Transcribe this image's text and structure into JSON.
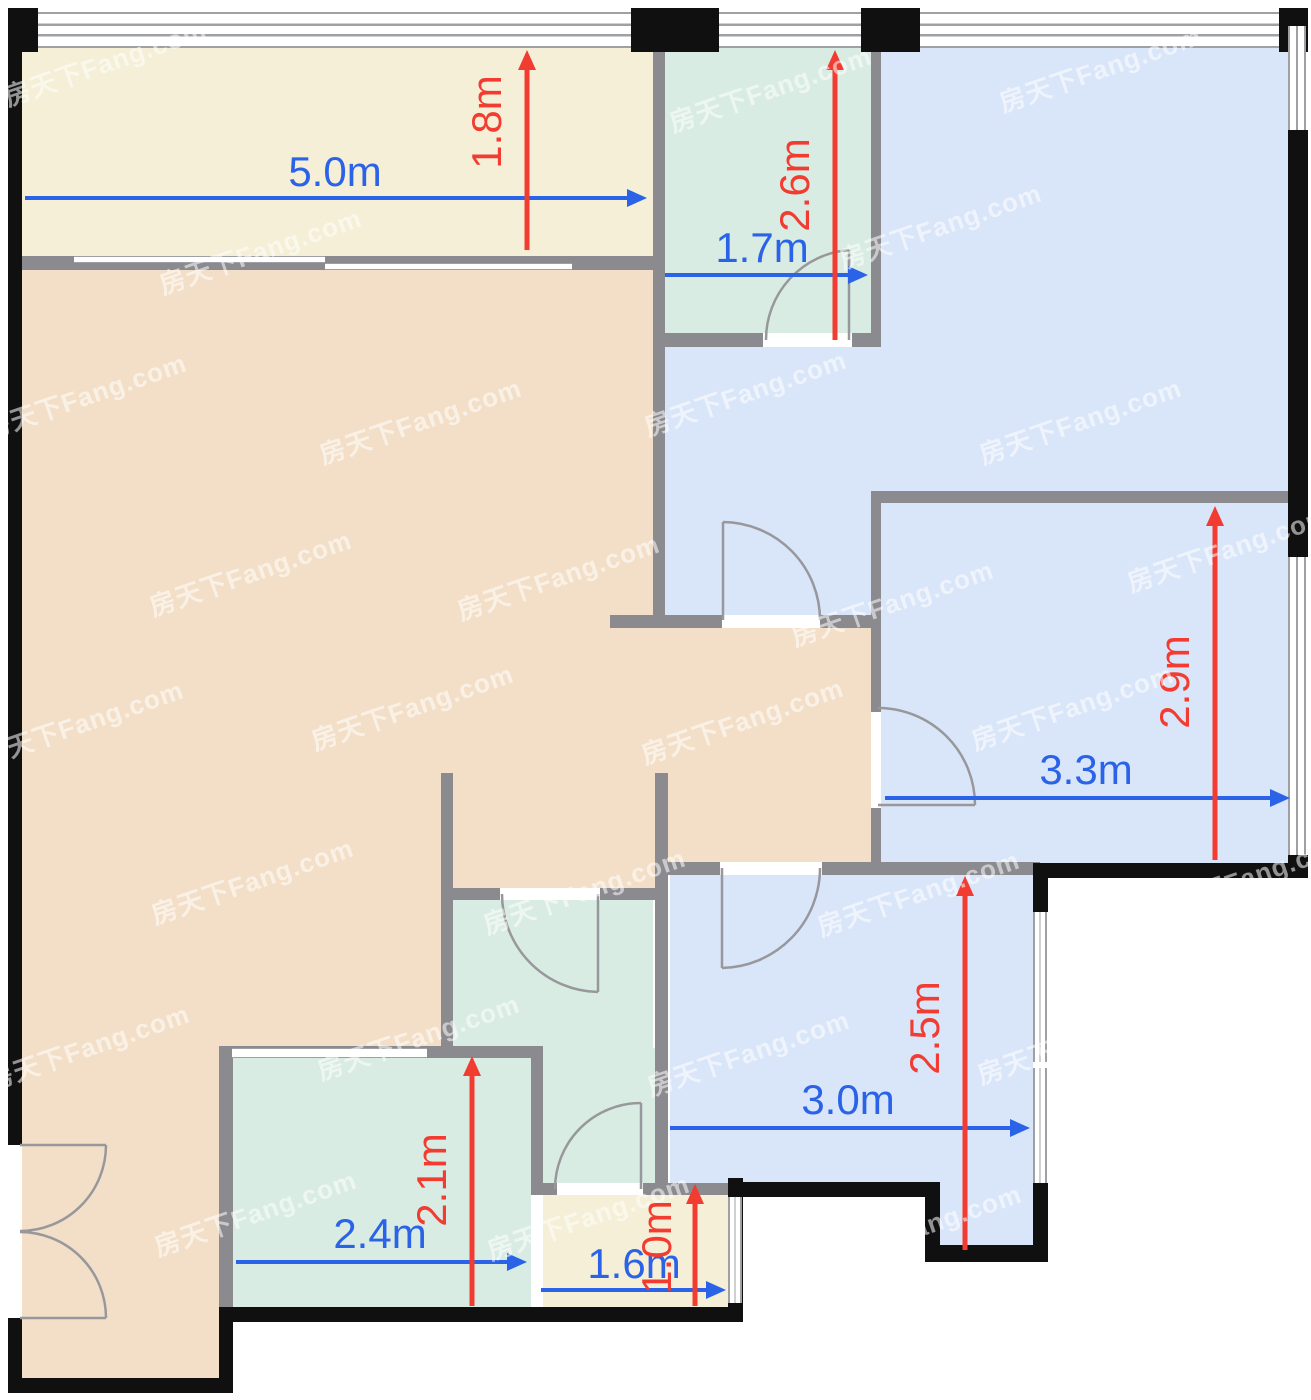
{
  "plan": {
    "width": 1311,
    "height": 1400,
    "watermark_text": "房天下Fang.com"
  },
  "colors": {
    "cream": "#f4efd6",
    "peach": "#f3dfc8",
    "teal": "#d9ece3",
    "blue": "#d9e5f9",
    "wall_gray": "#8b8b8f",
    "wall_black": "#101010",
    "dim_blue": "#2b63e8",
    "dim_red": "#f23c31",
    "door_stroke": "#98989c",
    "window_frame": "#9fa0a4",
    "watermark": "rgba(255,255,255,0.55)"
  },
  "rooms": [
    {
      "name": "balcony",
      "color": "cream",
      "rects": [
        [
          22,
          48,
          631,
          208
        ]
      ]
    },
    {
      "name": "living-room",
      "color": "peach",
      "rects": [
        [
          22,
          258,
          643,
          639
        ],
        [
          22,
          897,
          419,
          151
        ],
        [
          22,
          1048,
          197,
          337
        ],
        [
          653,
          628,
          228,
          234
        ]
      ]
    },
    {
      "name": "bedroom-top-right",
      "color": "blue",
      "rects": [
        [
          881,
          48,
          407,
          449
        ],
        [
          665,
          347,
          216,
          275
        ]
      ]
    },
    {
      "name": "utility-top",
      "color": "teal",
      "rects": [
        [
          663,
          48,
          208,
          289
        ]
      ]
    },
    {
      "name": "bedroom-right",
      "color": "blue",
      "rects": [
        [
          881,
          503,
          407,
          364
        ]
      ]
    },
    {
      "name": "bedroom-bottom",
      "color": "blue",
      "rects": [
        [
          670,
          875,
          363,
          315
        ],
        [
          940,
          1190,
          93,
          62
        ]
      ]
    },
    {
      "name": "bathroom-center",
      "color": "teal",
      "rects": [
        [
          453,
          897,
          200,
          151
        ],
        [
          543,
          1048,
          112,
          142
        ]
      ]
    },
    {
      "name": "bedroom-small",
      "color": "teal",
      "rects": [
        [
          233,
          1058,
          298,
          253
        ]
      ]
    },
    {
      "name": "kitchen-small",
      "color": "cream",
      "rects": [
        [
          543,
          1190,
          185,
          117
        ]
      ]
    }
  ],
  "walls": {
    "gray": [
      [
        653,
        28,
        12,
        600
      ],
      [
        653,
        333,
        228,
        14
      ],
      [
        871,
        28,
        10,
        319
      ],
      [
        610,
        615,
        271,
        13
      ],
      [
        875,
        491,
        421,
        12
      ],
      [
        871,
        491,
        10,
        376
      ],
      [
        655,
        862,
        385,
        13
      ],
      [
        441,
        773,
        12,
        275
      ],
      [
        441,
        888,
        224,
        12
      ],
      [
        531,
        1048,
        12,
        142
      ],
      [
        219,
        1046,
        324,
        12
      ],
      [
        219,
        1046,
        14,
        265
      ],
      [
        531,
        1183,
        197,
        12
      ],
      [
        655,
        773,
        13,
        417
      ],
      [
        22,
        256,
        631,
        14
      ]
    ],
    "black": [
      [
        8,
        8,
        14,
        1137
      ],
      [
        8,
        1318,
        14,
        75
      ],
      [
        8,
        1378,
        225,
        15
      ],
      [
        219,
        1311,
        14,
        82
      ],
      [
        219,
        1307,
        524,
        15
      ],
      [
        728,
        1178,
        15,
        144
      ],
      [
        733,
        1182,
        207,
        15
      ],
      [
        925,
        1182,
        15,
        78
      ],
      [
        925,
        1245,
        123,
        17
      ],
      [
        1033,
        863,
        15,
        49
      ],
      [
        1033,
        1183,
        15,
        79
      ],
      [
        1040,
        863,
        268,
        15
      ],
      [
        1288,
        8,
        20,
        18
      ],
      [
        1288,
        130,
        20,
        427
      ],
      [
        1288,
        855,
        20,
        23
      ],
      [
        8,
        8,
        30,
        44
      ],
      [
        631,
        8,
        88,
        44
      ],
      [
        861,
        8,
        59,
        44
      ],
      [
        1279,
        8,
        29,
        44
      ]
    ]
  },
  "windows": [
    {
      "rect": [
        38,
        12,
        593,
        36
      ],
      "style": "h2"
    },
    {
      "rect": [
        719,
        12,
        142,
        36
      ],
      "style": "h2"
    },
    {
      "rect": [
        920,
        12,
        359,
        36
      ],
      "style": "h2"
    },
    {
      "rect": [
        1288,
        26,
        18,
        104
      ],
      "style": "v"
    },
    {
      "rect": [
        1288,
        557,
        18,
        298
      ],
      "style": "v"
    },
    {
      "rect": [
        1033,
        912,
        14,
        150
      ],
      "style": "v"
    },
    {
      "rect": [
        1033,
        1068,
        14,
        115
      ],
      "style": "v"
    },
    {
      "rect": [
        728,
        1197,
        14,
        106
      ],
      "style": "v"
    },
    {
      "rect": [
        232,
        1048,
        195,
        10
      ],
      "style": "thin"
    },
    {
      "rect": [
        74,
        256,
        251,
        7
      ],
      "style": "thin"
    },
    {
      "rect": [
        325,
        263,
        247,
        7
      ],
      "style": "thin"
    }
  ],
  "door_openings": [
    [
      763,
      333,
      89,
      14
    ],
    [
      722,
      615,
      98,
      13
    ],
    [
      871,
      712,
      10,
      96
    ],
    [
      720,
      862,
      102,
      13
    ],
    [
      500,
      888,
      100,
      12
    ],
    [
      557,
      1183,
      86,
      12
    ],
    [
      8,
      1145,
      14,
      173
    ]
  ],
  "doors": [
    {
      "name": "door-utility-top",
      "leaf": "M849,340 L849,250",
      "arc": "M849,250 A90,90 0 0 0 766,340"
    },
    {
      "name": "door-bedroom-top-right",
      "leaf": "M723,620 L723,522",
      "arc": "M723,522 A98,98 0 0 1 820,620"
    },
    {
      "name": "door-bedroom-right",
      "leaf": "M878,805 L975,805",
      "arc": "M975,805 A97,97 0 0 0 878,708"
    },
    {
      "name": "door-bedroom-bottom",
      "leaf": "M722,868 L722,968",
      "arc": "M722,968 A100,100 0 0 0 820,868"
    },
    {
      "name": "door-bathroom-center",
      "leaf": "M598,894 L598,992",
      "arc": "M598,992 A98,98 0 0 1 502,894"
    },
    {
      "name": "door-kitchen-small",
      "leaf": "M641,1189 L641,1103",
      "arc": "M641,1103 A86,86 0 0 0 555,1189"
    },
    {
      "name": "french-door-left-top",
      "leaf": "M20,1145 L106,1145",
      "arc": "M106,1145 A86,86 0 0 1 20,1231"
    },
    {
      "name": "french-door-left-bottom",
      "leaf": "M20,1318 L106,1318",
      "arc": "M106,1318 A86,86 0 0 0 20,1232"
    }
  ],
  "dimensions": {
    "horizontal": [
      {
        "label": "5.0m",
        "x1": 25,
        "x2": 645,
        "y": 198,
        "lx": 335,
        "ly": 186
      },
      {
        "label": "1.7m",
        "x1": 665,
        "x2": 866,
        "y": 275,
        "lx": 762,
        "ly": 262
      },
      {
        "label": "3.3m",
        "x1": 885,
        "x2": 1288,
        "y": 798,
        "lx": 1086,
        "ly": 784
      },
      {
        "label": "3.0m",
        "x1": 670,
        "x2": 1028,
        "y": 1128,
        "lx": 848,
        "ly": 1114
      },
      {
        "label": "2.4m",
        "x1": 236,
        "x2": 525,
        "y": 1262,
        "lx": 380,
        "ly": 1248
      },
      {
        "label": "1.6m",
        "x1": 541,
        "x2": 724,
        "y": 1290,
        "lx": 634,
        "ly": 1278
      }
    ],
    "vertical": [
      {
        "label": "1.8m",
        "x": 527,
        "y1": 250,
        "y2": 52,
        "lx": 501,
        "ly": 122
      },
      {
        "label": "2.6m",
        "x": 835,
        "y1": 340,
        "y2": 52,
        "lx": 809,
        "ly": 185
      },
      {
        "label": "2.9m",
        "x": 1215,
        "y1": 860,
        "y2": 508,
        "lx": 1189,
        "ly": 682
      },
      {
        "label": "2.5m",
        "x": 965,
        "y1": 1250,
        "y2": 878,
        "lx": 939,
        "ly": 1028
      },
      {
        "label": "2.1m",
        "x": 472,
        "y1": 1306,
        "y2": 1058,
        "lx": 446,
        "ly": 1180
      },
      {
        "label": "1.0m",
        "x": 695,
        "y1": 1306,
        "y2": 1186,
        "lx": 671,
        "ly": 1247
      }
    ]
  },
  "watermarks": [
    [
      105,
      62
    ],
    [
      770,
      88
    ],
    [
      1100,
      68
    ],
    [
      940,
      225
    ],
    [
      260,
      250
    ],
    [
      85,
      395
    ],
    [
      420,
      420
    ],
    [
      745,
      392
    ],
    [
      1080,
      420
    ],
    [
      250,
      572
    ],
    [
      558,
      576
    ],
    [
      892,
      602
    ],
    [
      1228,
      548
    ],
    [
      82,
      722
    ],
    [
      412,
      706
    ],
    [
      742,
      720
    ],
    [
      1072,
      706
    ],
    [
      252,
      880
    ],
    [
      584,
      890
    ],
    [
      918,
      892
    ],
    [
      1248,
      876
    ],
    [
      88,
      1046
    ],
    [
      418,
      1036
    ],
    [
      748,
      1052
    ],
    [
      1078,
      1040
    ],
    [
      255,
      1212
    ],
    [
      588,
      1216
    ],
    [
      920,
      1226
    ],
    [
      424,
      1362
    ],
    [
      754,
      1348
    ]
  ]
}
